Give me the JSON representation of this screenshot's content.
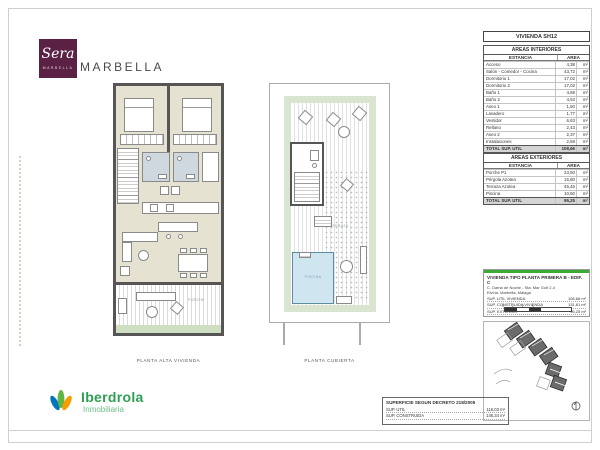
{
  "brand": {
    "logo_script": "Sera",
    "logo_sub": "MARBELLA",
    "wordmark": "MARBELLA",
    "logo_bg": "#5a2144"
  },
  "plans": {
    "left": {
      "caption": "PLANTA ALTA VIVIENDA",
      "porch_label": "PORCHE"
    },
    "right": {
      "caption": "PLANTA CUBIERTA",
      "pool_label": "PISCINA",
      "terrace_label": "TERRAZA"
    }
  },
  "unit_title": "VIVIENDA SH12",
  "interior_table": {
    "title": "AREAS INTERIORES",
    "col_room": "ESTANCIA",
    "col_area": "AREA",
    "rows": [
      [
        "Acceso",
        "4,38",
        "m²"
      ],
      [
        "Salón - Comedor - Cocina",
        "43,72",
        "m²"
      ],
      [
        "Dormitorio 1",
        "17,02",
        "m²"
      ],
      [
        "Dormitorio 2",
        "17,02",
        "m²"
      ],
      [
        "Baño 1",
        "4,69",
        "m²"
      ],
      [
        "Baño 2",
        "4,53",
        "m²"
      ],
      [
        "Aseo 1",
        "1,50",
        "m²"
      ],
      [
        "Lavadero",
        "1,77",
        "m²"
      ],
      [
        "Vestidor",
        "6,63",
        "m²"
      ],
      [
        "Rellano",
        "2,43",
        "m²"
      ],
      [
        "Aseo 2",
        "2,37",
        "m²"
      ],
      [
        "Instalaciones",
        "2,69",
        "m²"
      ]
    ],
    "totals": [
      [
        "TOTAL SUP. UTIL",
        "108,66",
        "m²"
      ],
      [
        "TOTAL SUP. CONSTRUIDA",
        "131,81",
        "m²"
      ]
    ]
  },
  "exterior_table": {
    "title": "AREAS EXTERIORES",
    "col_room": "ESTANCIA",
    "col_area": "AREA",
    "rows": [
      [
        "Porche P1",
        "23,50",
        "m²"
      ],
      [
        "Pérgola Azotea",
        "15,80",
        "m²"
      ],
      [
        "Terraza Azotea",
        "45,45",
        "m²"
      ],
      [
        "Piscina",
        "10,50",
        "m²"
      ]
    ],
    "totals": [
      [
        "TOTAL SUP. UTIL",
        "95,25",
        "m²"
      ]
    ]
  },
  "info_box": {
    "accent": "#3aaa35",
    "title": "VIVIENDA TIPO PLANTA PRIMERA B - EDIF. C",
    "address1": "C. Dama de Noche - Sta. Mar Golf 2-4",
    "address2": "Elviria, Marbella, Málaga",
    "rows": [
      [
        "SUP. UTIL VIVIENDA",
        "108,66 m²"
      ],
      [
        "SUP. CONSTRUIDA VIVIENDA",
        "131,81 m²"
      ],
      [
        "SUP. EXTERIOR",
        "95,25 m²"
      ]
    ],
    "scale_text": "0 1 2 5"
  },
  "decree_box": {
    "title": "SUPERFICIE SEGUN DECRETO 218/2005",
    "rows": [
      [
        "SUP. UTIL",
        "116,03 m²"
      ],
      [
        "SUP. CONSTRUIDA",
        "146,34 m²"
      ]
    ]
  },
  "footer_brand": {
    "name": "Iberdrola",
    "sub": "Inmobiliaria",
    "color": "#2fa053"
  }
}
